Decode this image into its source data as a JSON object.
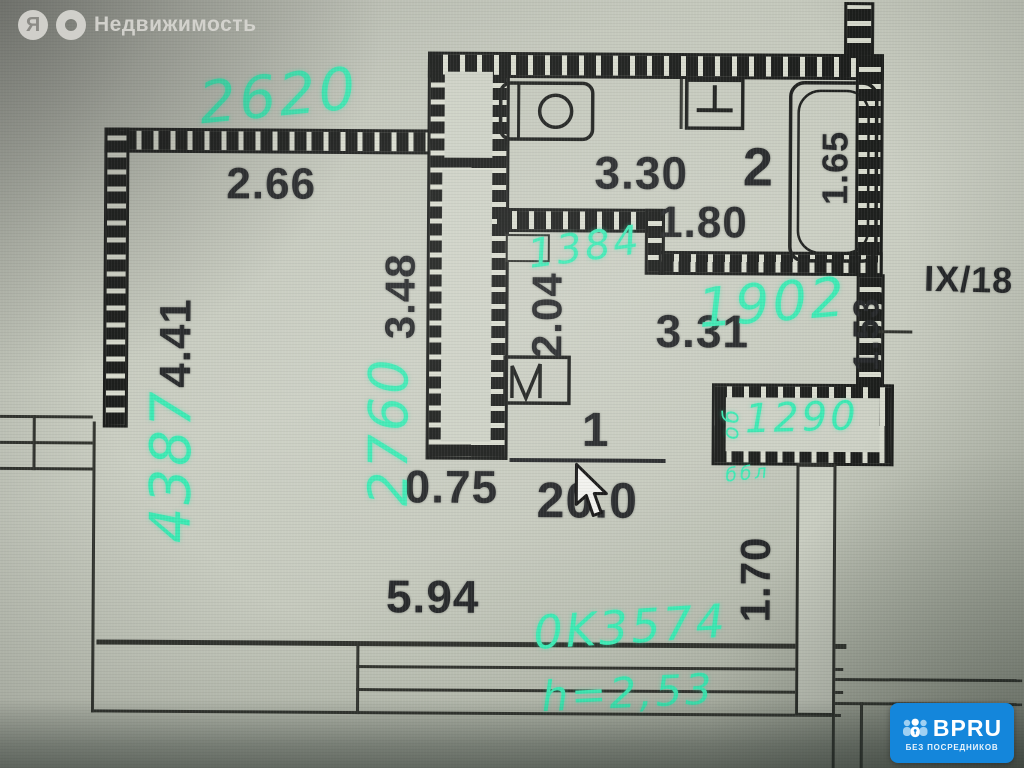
{
  "watermark": {
    "brand_letter": "Я",
    "name": "Недвижимость"
  },
  "floor_plan": {
    "floor_note": "IX/18",
    "rooms": [
      {
        "number": "1",
        "area": "20.0"
      },
      {
        "number": "2",
        "area": "3.30"
      }
    ],
    "printed_dims": {
      "room_top_width": "2.66",
      "room_left_height": "4.41",
      "partition_height": "3.48",
      "bath_width": "1.80",
      "tub_length": "1.65",
      "kitchen_depth": "2.04",
      "kitchen_length": "3.31",
      "niche_width": "1.53",
      "door_width": "0.75",
      "bottom_width": "5.94",
      "right_depth": "1.70"
    },
    "marker_notes": {
      "top_mm": "2620",
      "left_mm": "4387",
      "mid_mm": "2760",
      "kitchen_mm": "1384",
      "hall_mm": "1902",
      "closet_mm": "1290",
      "closet_tag": "об",
      "closet_tag2": "ббл",
      "window_mm": "0K3574",
      "ceiling_height": "h=2,53"
    },
    "marker_color": "#3deab4",
    "ink_color": "#26282a"
  },
  "badge": {
    "name": "BPRU",
    "tagline": "БЕЗ ПОСРЕДНИКОВ",
    "color": "#1486db"
  }
}
